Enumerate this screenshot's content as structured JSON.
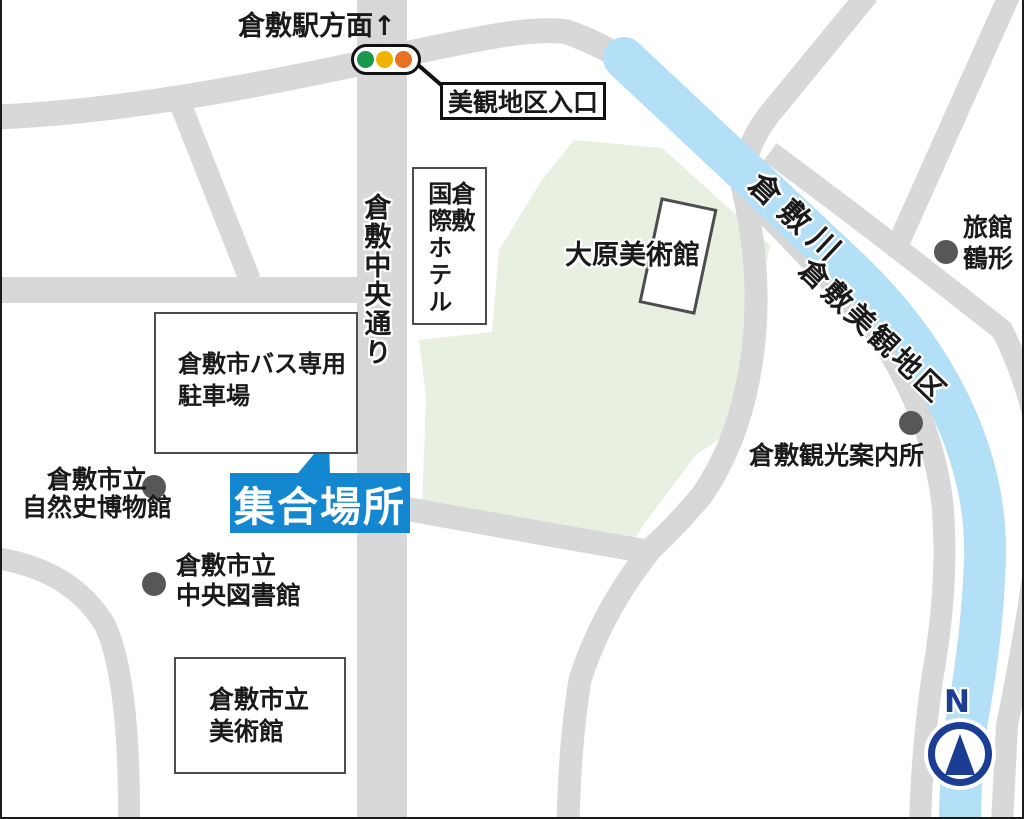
{
  "colors": {
    "road": "#d8d8d8",
    "green_area": "#e8f0e1",
    "river": "#b3e0f7",
    "accent_blue": "#1487d1",
    "poi_dot": "#575757",
    "compass_navy": "#1b3d94",
    "signal_green": "#18984a",
    "signal_yellow": "#f0b400",
    "signal_orange": "#e87122",
    "line_black": "#111111"
  },
  "header": {
    "station_direction": "倉敷駅方面↑"
  },
  "traffic_signal": {
    "label": "美観地区入口"
  },
  "roads": {
    "main_street": "倉敷中央通り"
  },
  "river": {
    "name": "倉敷川",
    "district": "倉敷美観地区"
  },
  "places": {
    "hotel": {
      "line1": "倉敷",
      "line2": "国際ホテル"
    },
    "ohara_museum": {
      "label": "大原美術館"
    },
    "bus_parking": {
      "line1": "倉敷市バス専用",
      "line2": "駐車場"
    },
    "meeting_point": {
      "label": "集合場所"
    },
    "natural_history_museum": {
      "line1": "倉敷市立",
      "line2": "自然史博物館"
    },
    "central_library": {
      "line1": "倉敷市立",
      "line2": "中央図書館"
    },
    "city_art_museum": {
      "line1": "倉敷市立",
      "line2": "美術館"
    },
    "tourist_information": {
      "label": "倉敷観光案内所"
    },
    "ryokan": {
      "line1": "旅館",
      "line2": "鶴形"
    }
  },
  "compass": {
    "label": "N"
  }
}
